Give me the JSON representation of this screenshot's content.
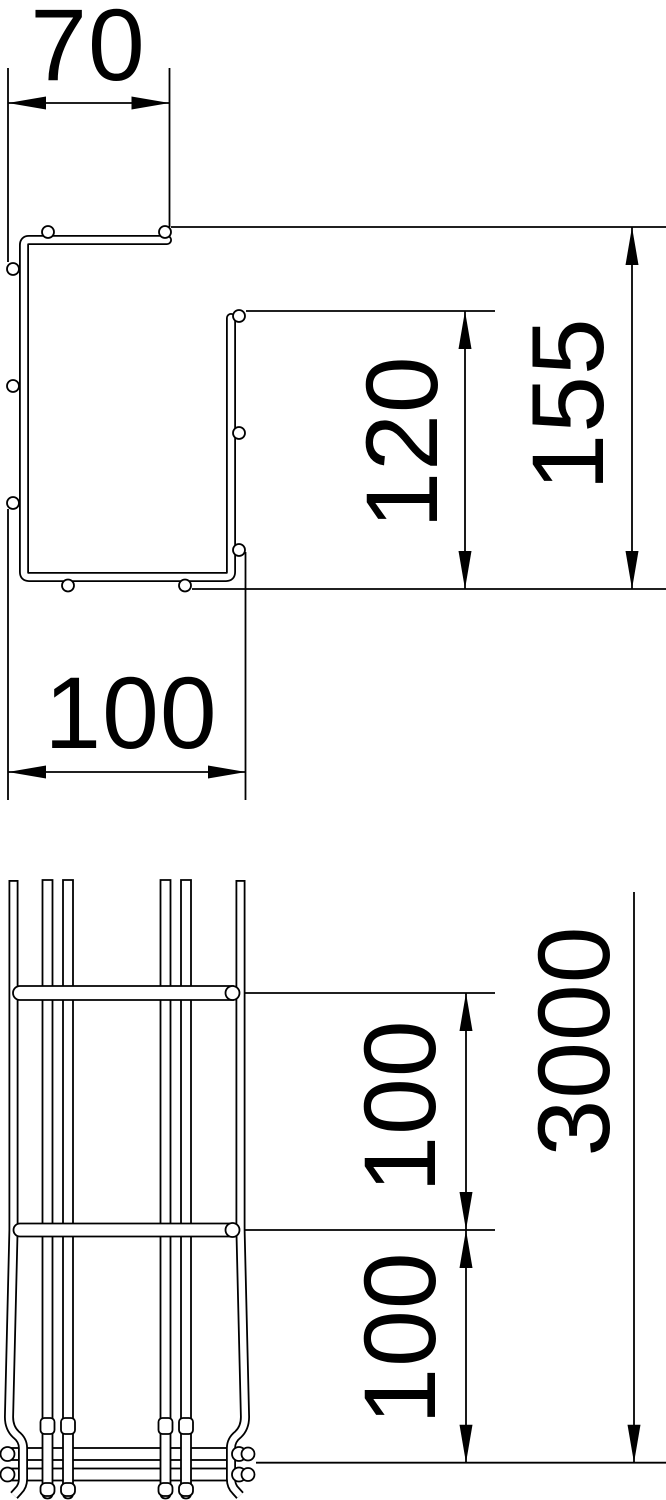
{
  "drawing": {
    "title": "Mesh cable tray dimensional drawing",
    "colors": {
      "background": "#ffffff",
      "line": "#000000"
    },
    "cross_section_view": {
      "description": "G-profile cross section",
      "width_top": "70",
      "inner_height": "120",
      "overall_height": "155",
      "width_bottom": "100"
    },
    "side_view": {
      "description": "Side view of mesh tray end",
      "spacing_upper": "100",
      "spacing_lower": "100",
      "length": "3000"
    }
  }
}
